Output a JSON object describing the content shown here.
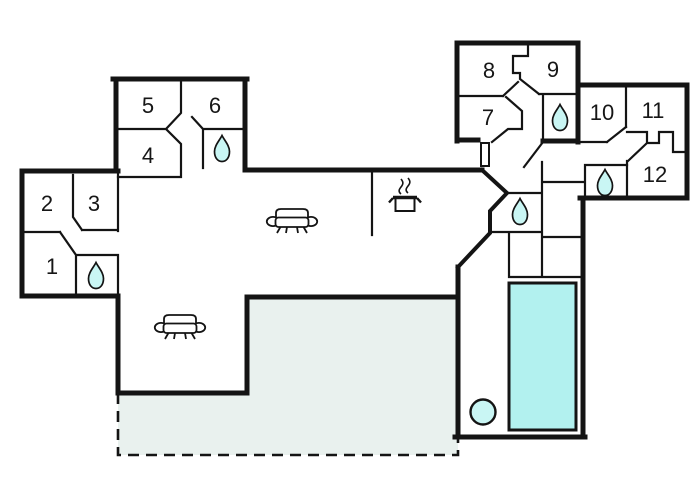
{
  "plan": {
    "title": "house-floor-plan",
    "rooms": [
      {
        "number": "1"
      },
      {
        "number": "2"
      },
      {
        "number": "3"
      },
      {
        "number": "4"
      },
      {
        "number": "5"
      },
      {
        "number": "6"
      },
      {
        "number": "7"
      },
      {
        "number": "8"
      },
      {
        "number": "9"
      },
      {
        "number": "10"
      },
      {
        "number": "11"
      },
      {
        "number": "12"
      }
    ],
    "features": {
      "bathroom_drop_icons": 5,
      "sofa_icons": 2,
      "stove_icon": 1,
      "pool": "swimming-pool",
      "hot_tub": "round-tub",
      "terrace": "dashed-outline-terrace",
      "door": "open-door-marker"
    }
  },
  "colors": {
    "wall": "#141414",
    "pool": "#b2f1ef",
    "drop": "#c9f6f4",
    "terrace": "#e9f1ee",
    "paper": "#ffffff"
  }
}
